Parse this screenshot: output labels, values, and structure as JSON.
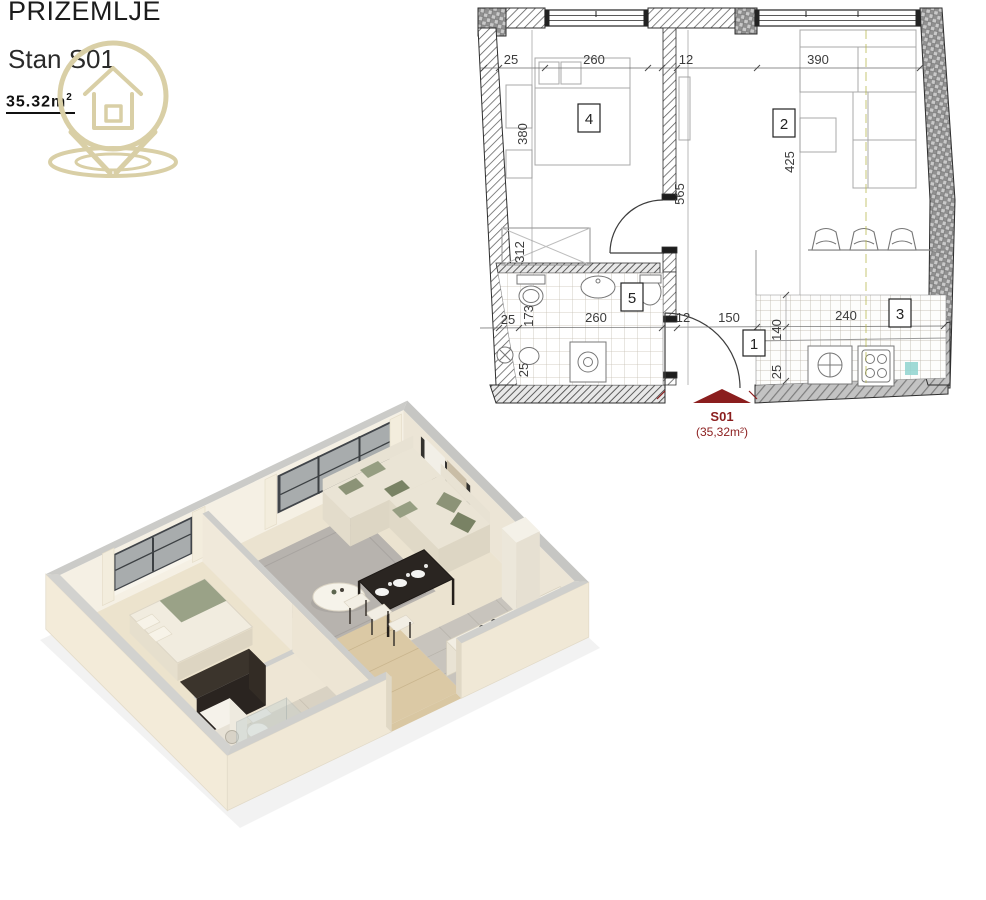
{
  "header": {
    "title": "PRIZEMLJE",
    "subtitle": "Stan S01",
    "area_value": "35.32m",
    "area_sup": "2"
  },
  "icons": {
    "logo": "house-location-pin"
  },
  "colors": {
    "accent_red": "#8b1e1e",
    "logo_tan": "#d9cfa6",
    "wall_cream": "#f2ecdf",
    "sage": "#9aa287"
  },
  "floorplan": {
    "marker": {
      "label": "S01",
      "area": "(35,32m²)"
    },
    "rooms": {
      "r1": "1",
      "r2": "2",
      "r3": "3",
      "r4": "4",
      "r5": "5"
    },
    "dims": {
      "top_25": "25",
      "top_260": "260",
      "top_12": "12",
      "top_390": "390",
      "left_380": "380",
      "left_312": "312",
      "mid_25": "25",
      "mid_173": "173",
      "mid_260": "260",
      "mid_12": "12",
      "mid_150": "150",
      "bath_25": "25",
      "hall_565": "565",
      "right_425": "425",
      "kit_140": "140",
      "kit_240": "240",
      "kit_25": "25"
    }
  }
}
